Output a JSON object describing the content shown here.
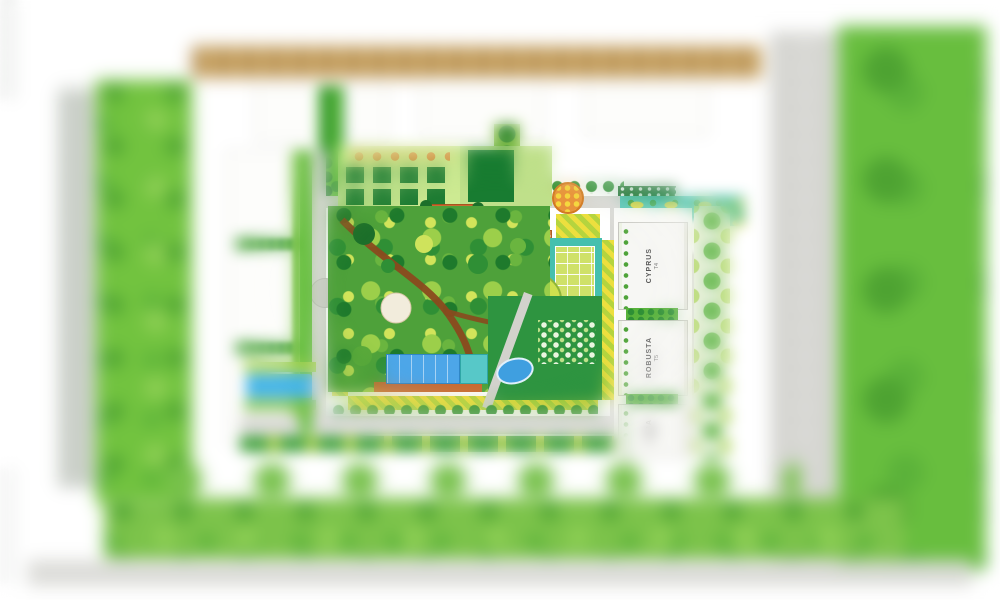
{
  "plan": {
    "towers": [
      {
        "name": "CYPRUS",
        "code": "T4"
      },
      {
        "name": "ROBUSTA",
        "code": "T5"
      },
      {
        "name": "ALBA",
        "code": "T6"
      }
    ],
    "colors": {
      "lawn": "#2e9440",
      "grass_band": "#72c33f",
      "field": "#68be3e",
      "pool_blue": "#4da6e8",
      "teal_water": "#4cc4b4",
      "deck_orange": "#c96a30",
      "hatch_yellow": "#ecdf3e",
      "hatch_green": "#b5d43e",
      "road_gray": "#d8d8d4",
      "tan_band": "#c9a463",
      "path_brown": "#8a4a1e"
    }
  }
}
